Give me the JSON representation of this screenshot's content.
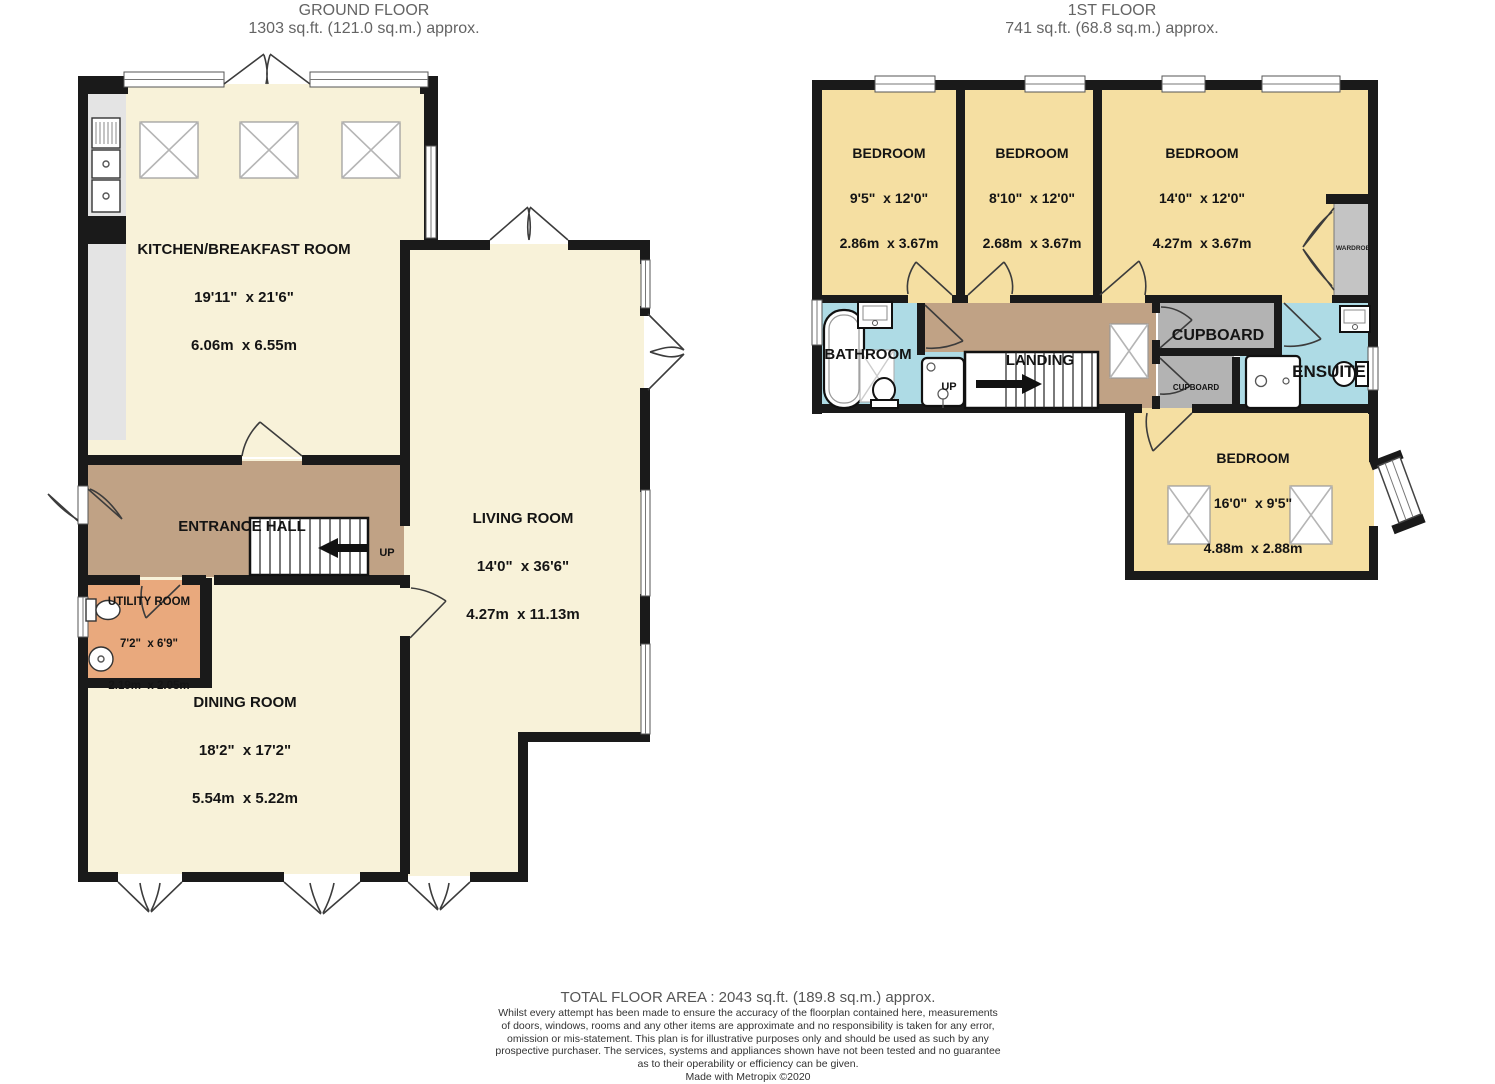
{
  "ground_floor": {
    "title": "GROUND FLOOR",
    "subtitle": "1303 sq.ft. (121.0 sq.m.) approx.",
    "stairs_label": "UP",
    "rooms": {
      "kitchen": {
        "name": "KITCHEN/BREAKFAST ROOM",
        "imperial": "19'11\"  x 21'6\"",
        "metric": "6.06m  x 6.55m"
      },
      "entrance_hall": {
        "name": "ENTRANCE HALL"
      },
      "living_room": {
        "name": "LIVING ROOM",
        "imperial": "14'0\"  x 36'6\"",
        "metric": "4.27m  x 11.13m"
      },
      "utility": {
        "name": "UTILITY ROOM",
        "imperial": "7'2\"  x 6'9\"",
        "metric": "2.19m  x 2.05m"
      },
      "dining": {
        "name": "DINING ROOM",
        "imperial": "18'2\"  x 17'2\"",
        "metric": "5.54m  x 5.22m"
      }
    }
  },
  "first_floor": {
    "title": "1ST FLOOR",
    "subtitle": "741 sq.ft. (68.8 sq.m.) approx.",
    "stairs_label": "UP",
    "rooms": {
      "bedroom1": {
        "name": "BEDROOM",
        "imperial": "9'5\"  x 12'0\"",
        "metric": "2.86m  x 3.67m"
      },
      "bedroom2": {
        "name": "BEDROOM",
        "imperial": "8'10\"  x 12'0\"",
        "metric": "2.68m  x 3.67m"
      },
      "bedroom3": {
        "name": "BEDROOM",
        "imperial": "14'0\"  x 12'0\"",
        "metric": "4.27m  x 3.67m"
      },
      "bedroom4": {
        "name": "BEDROOM",
        "imperial": "16'0\"  x 9'5\"",
        "metric": "4.88m  x 2.88m"
      },
      "bathroom": {
        "name": "BATHROOM"
      },
      "landing": {
        "name": "LANDING"
      },
      "ensuite": {
        "name": "ENSUITE"
      },
      "cupboard_top": {
        "name": "CUPBOARD"
      },
      "cupboard_bottom": {
        "name": "CUPBOARD"
      },
      "wardrobe": {
        "name": "WARDROBE"
      }
    }
  },
  "footer": {
    "total_area": "TOTAL FLOOR AREA : 2043 sq.ft. (189.8 sq.m.) approx.",
    "disclaimer_lines": [
      "Whilst every attempt has been made to ensure the accuracy of the floorplan contained here, measurements",
      "of doors, windows, rooms and any other items are approximate and no responsibility is taken for any error,",
      "omission or mis-statement. This plan is for illustrative purposes only and should be used as such by any",
      "prospective purchaser. The services, systems and appliances shown have not been tested and no guarantee",
      "as to their operability or efficiency can be given."
    ],
    "credit": "Made with Metropix ©2020"
  },
  "colors": {
    "wall": "#1a1a1a",
    "floor_cream": "#f8f2d9",
    "floor_yellow": "#f5dfa2",
    "floor_hall": "#c0a285",
    "floor_utility": "#e9a97d",
    "floor_bath": "#aedbe5",
    "cupboard_grey": "#b3b3b3",
    "wardrobe_grey": "#c4c4c4",
    "counter_grey": "#e4e4e4",
    "title_text": "#646464"
  }
}
